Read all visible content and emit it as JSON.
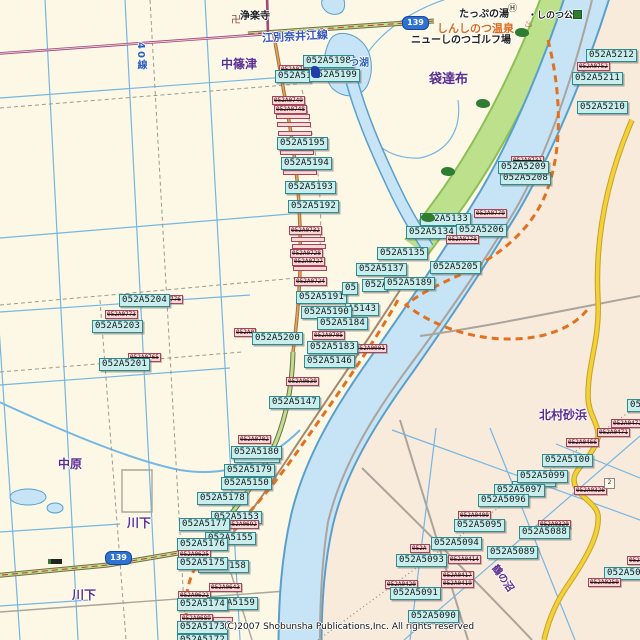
{
  "map": {
    "copyright": "(C)2007 Shobunsha Publications,Inc. All rights reserved",
    "colors": {
      "land_left": "#FDF8E6",
      "land_right": "#F8EBDB",
      "water_fill": "#C6E4F6",
      "water_line": "#58A0CC",
      "green_belt": "#BCE08C",
      "cyan_label_bg": "#C9ECEC",
      "cyan_label_border": "#2F8C8C",
      "pink_label_bg": "#F8D9DB",
      "pink_label_border": "#AA4455",
      "road_yellow": "#F2D235",
      "road_orange": "#E2701C",
      "road_green": "#BEE08E",
      "road_maroon": "#A04878",
      "purple_text": "#5B2D8E",
      "blue_text": "#2B5FC0",
      "badge_blue": "#2E72D2"
    },
    "route_badges": [
      {
        "text": "139",
        "x": 402,
        "y": 16
      },
      {
        "text": "139",
        "x": 105,
        "y": 551
      }
    ],
    "places": [
      {
        "text": "浄楽寺",
        "x": 240,
        "y": 7,
        "c": "#222222",
        "s": 10
      },
      {
        "text": "江別奈井江線",
        "x": 262,
        "y": 28,
        "c": "#3355BB",
        "s": 11,
        "rot": -3
      },
      {
        "text": "中篠津",
        "x": 221,
        "y": 55,
        "c": "#5B2D8E",
        "s": 12
      },
      {
        "text": "40線",
        "x": 133,
        "y": 42,
        "c": "#2B5FC0",
        "s": 10,
        "vert": true
      },
      {
        "text": "つ湖",
        "x": 349,
        "y": 54,
        "c": "#2B5FC0",
        "s": 10
      },
      {
        "text": "たっぷの湯",
        "x": 459,
        "y": 5,
        "c": "#222222",
        "s": 10
      },
      {
        "text": "・しのつ公園",
        "x": 528,
        "y": 8,
        "c": "#222222",
        "s": 9
      },
      {
        "text": "しんしのつ温泉",
        "x": 437,
        "y": 20,
        "c": "#E06818",
        "s": 11
      },
      {
        "text": "ニューしのつゴルフ場",
        "x": 411,
        "y": 31,
        "c": "#222222",
        "s": 10
      },
      {
        "text": "袋達布",
        "x": 429,
        "y": 68,
        "c": "#5B2D8E",
        "s": 13
      },
      {
        "text": "北村砂浜",
        "x": 539,
        "y": 406,
        "c": "#5B2D8E",
        "s": 12
      },
      {
        "text": "中原",
        "x": 58,
        "y": 455,
        "c": "#5B2D8E",
        "s": 12
      },
      {
        "text": "川下",
        "x": 127,
        "y": 514,
        "c": "#5B2D8E",
        "s": 12
      },
      {
        "text": "川下",
        "x": 72,
        "y": 586,
        "c": "#5B2D8E",
        "s": 12
      },
      {
        "text": "鶴の沼",
        "x": 489,
        "y": 570,
        "c": "#5B2D8E",
        "s": 10,
        "rot": 55
      }
    ],
    "labels": [
      {
        "type": "pink",
        "text": "052A0751",
        "x": 279,
        "y": 65
      },
      {
        "type": "cyan",
        "text": "052A51",
        "x": 275,
        "y": 70,
        "w": 36
      },
      {
        "type": "cyan",
        "text": "052A5198",
        "x": 303,
        "y": 55
      },
      {
        "type": "cyan",
        "text": "052A5199",
        "x": 309,
        "y": 69
      },
      {
        "type": "pink-strip",
        "x": 276,
        "y": 114,
        "w": 34
      },
      {
        "type": "pink-strip",
        "x": 277,
        "y": 122,
        "w": 34
      },
      {
        "type": "pink-strip",
        "x": 278,
        "y": 131,
        "w": 34
      },
      {
        "type": "pink",
        "text": "052A0749",
        "x": 272,
        "y": 96
      },
      {
        "type": "pink",
        "text": "052A0748",
        "x": 274,
        "y": 105
      },
      {
        "type": "pink-strip",
        "x": 280,
        "y": 150,
        "w": 34
      },
      {
        "type": "cyan",
        "text": "052A5195",
        "x": 277,
        "y": 137
      },
      {
        "type": "pink-strip",
        "x": 283,
        "y": 170,
        "w": 34
      },
      {
        "type": "cyan",
        "text": "052A5194",
        "x": 281,
        "y": 157
      },
      {
        "type": "cyan",
        "text": "052A5193",
        "x": 285,
        "y": 181
      },
      {
        "type": "cyan",
        "text": "052A5192",
        "x": 288,
        "y": 200
      },
      {
        "type": "pink",
        "text": "052A0732",
        "x": 289,
        "y": 226
      },
      {
        "type": "pink-strip",
        "x": 291,
        "y": 237,
        "w": 34
      },
      {
        "type": "pink-strip",
        "x": 292,
        "y": 244,
        "w": 34
      },
      {
        "type": "pink",
        "text": "052A0728",
        "x": 290,
        "y": 249
      },
      {
        "type": "pink",
        "text": "052A0727",
        "x": 292,
        "y": 257
      },
      {
        "type": "pink-strip",
        "x": 293,
        "y": 266,
        "w": 34
      },
      {
        "type": "pink",
        "text": "052A0724",
        "x": 294,
        "y": 277
      },
      {
        "type": "cyan",
        "text": "052A5191",
        "x": 296,
        "y": 291
      },
      {
        "type": "cyan",
        "text": "05",
        "x": 342,
        "y": 282,
        "w": 16
      },
      {
        "type": "cyan",
        "text": "052A",
        "x": 362,
        "y": 279,
        "w": 26
      },
      {
        "type": "cyan",
        "text": "A5143",
        "x": 345,
        "y": 303,
        "w": 34
      },
      {
        "type": "cyan",
        "text": "052A5190",
        "x": 301,
        "y": 306
      },
      {
        "type": "cyan",
        "text": "052A5189",
        "x": 384,
        "y": 277
      },
      {
        "type": "pink",
        "text": "052A0705",
        "x": 312,
        "y": 331
      },
      {
        "type": "cyan",
        "text": "052A5184",
        "x": 317,
        "y": 317
      },
      {
        "type": "pink",
        "text": "052A0001",
        "x": 354,
        "y": 344
      },
      {
        "type": "cyan",
        "text": "052A5183",
        "x": 307,
        "y": 341
      },
      {
        "type": "cyan",
        "text": "052A5146",
        "x": 304,
        "y": 355
      },
      {
        "type": "pink",
        "text": "052A0630",
        "x": 286,
        "y": 377
      },
      {
        "type": "cyan",
        "text": "052A5147",
        "x": 269,
        "y": 396
      },
      {
        "type": "pink",
        "text": "052A0779",
        "x": 474,
        "y": 209
      },
      {
        "type": "cyan",
        "text": "052A5133",
        "x": 420,
        "y": 213
      },
      {
        "type": "cyan",
        "text": "052A5134",
        "x": 406,
        "y": 226
      },
      {
        "type": "cyan",
        "text": "052A5206",
        "x": 456,
        "y": 224
      },
      {
        "type": "pink",
        "text": "052A0778",
        "x": 446,
        "y": 235
      },
      {
        "type": "cyan",
        "text": "052A5135",
        "x": 377,
        "y": 247
      },
      {
        "type": "cyan",
        "text": "052A5137",
        "x": 356,
        "y": 263
      },
      {
        "type": "cyan",
        "text": "052A5205",
        "x": 430,
        "y": 261
      },
      {
        "type": "pink",
        "text": "052A0731",
        "x": 511,
        "y": 156
      },
      {
        "type": "cyan",
        "text": "052A5208",
        "x": 500,
        "y": 172
      },
      {
        "type": "cyan",
        "text": "052A5209",
        "x": 498,
        "y": 161
      },
      {
        "type": "cyan",
        "text": "052A5212",
        "x": 586,
        "y": 49
      },
      {
        "type": "pink",
        "text": "052A0752",
        "x": 577,
        "y": 62
      },
      {
        "type": "cyan",
        "text": "052A5211",
        "x": 572,
        "y": 72
      },
      {
        "type": "cyan",
        "text": "052A5210",
        "x": 577,
        "y": 101
      },
      {
        "type": "pink",
        "text": "052A0776",
        "x": 150,
        "y": 295
      },
      {
        "type": "cyan",
        "text": "052A5204",
        "x": 119,
        "y": 294
      },
      {
        "type": "pink",
        "text": "052A0773",
        "x": 105,
        "y": 310
      },
      {
        "type": "cyan",
        "text": "052A5203",
        "x": 92,
        "y": 320
      },
      {
        "type": "pink",
        "text": "052A0765",
        "x": 128,
        "y": 353
      },
      {
        "type": "cyan",
        "text": "052A5201",
        "x": 99,
        "y": 358
      },
      {
        "type": "pink",
        "text": "052A07",
        "x": 234,
        "y": 328,
        "w": 22
      },
      {
        "type": "cyan",
        "text": "052A5200",
        "x": 252,
        "y": 332
      },
      {
        "type": "pink",
        "text": "052A0702",
        "x": 238,
        "y": 435
      },
      {
        "type": "cyan-strip",
        "x": 234,
        "y": 457,
        "w": 46
      },
      {
        "type": "cyan",
        "text": "052A5180",
        "x": 231,
        "y": 446
      },
      {
        "type": "cyan",
        "text": "052A5179",
        "x": 224,
        "y": 464
      },
      {
        "type": "cyan",
        "text": "052A5150",
        "x": 221,
        "y": 477
      },
      {
        "type": "cyan",
        "text": "052A5178",
        "x": 197,
        "y": 492
      },
      {
        "type": "cyan",
        "text": "052A5153",
        "x": 211,
        "y": 511
      },
      {
        "type": "pink",
        "text": "052A0692",
        "x": 226,
        "y": 520
      },
      {
        "type": "cyan",
        "text": "052A5177",
        "x": 179,
        "y": 518
      },
      {
        "type": "cyan",
        "text": "052A5155",
        "x": 205,
        "y": 532
      },
      {
        "type": "cyan",
        "text": "052A5176",
        "x": 177,
        "y": 538
      },
      {
        "type": "pink",
        "text": "052A0625",
        "x": 178,
        "y": 550
      },
      {
        "type": "cyan",
        "text": "052A5158",
        "x": 198,
        "y": 560
      },
      {
        "type": "cyan",
        "text": "052A5175",
        "x": 177,
        "y": 557
      },
      {
        "type": "pink",
        "text": "052A0643",
        "x": 209,
        "y": 583
      },
      {
        "type": "pink",
        "text": "052A0622",
        "x": 178,
        "y": 591
      },
      {
        "type": "cyan",
        "text": "052A5159",
        "x": 207,
        "y": 597
      },
      {
        "type": "cyan",
        "text": "052A5174",
        "x": 177,
        "y": 598
      },
      {
        "type": "pink",
        "text": "052A0689",
        "x": 180,
        "y": 614
      },
      {
        "type": "pink-strip",
        "x": 213,
        "y": 617,
        "w": 20
      },
      {
        "type": "cyan",
        "text": "052A5173",
        "x": 177,
        "y": 621
      },
      {
        "type": "cyan",
        "text": "052A5172",
        "x": 177,
        "y": 634
      },
      {
        "type": "cyan",
        "text": "05",
        "x": 627,
        "y": 399,
        "w": 14
      },
      {
        "type": "pink",
        "text": "052A0472",
        "x": 611,
        "y": 419
      },
      {
        "type": "pink",
        "text": "052A0471",
        "x": 597,
        "y": 428
      },
      {
        "type": "pink",
        "text": "052A0466",
        "x": 566,
        "y": 438
      },
      {
        "type": "cyan",
        "text": "052A5100",
        "x": 542,
        "y": 454
      },
      {
        "type": "cyan-strip",
        "x": 512,
        "y": 481,
        "w": 44
      },
      {
        "type": "cyan",
        "text": "052A5099",
        "x": 517,
        "y": 470
      },
      {
        "type": "cyan",
        "text": "052A5097",
        "x": 494,
        "y": 484
      },
      {
        "type": "cyan",
        "text": "052A5096",
        "x": 478,
        "y": 494
      },
      {
        "type": "pink",
        "text": "052A0326",
        "x": 574,
        "y": 486
      },
      {
        "type": "pink",
        "text": "052A0400",
        "x": 458,
        "y": 511
      },
      {
        "type": "cyan",
        "text": "052A5095",
        "x": 454,
        "y": 519
      },
      {
        "type": "pink",
        "text": "052A0320",
        "x": 538,
        "y": 520
      },
      {
        "type": "cyan",
        "text": "052A5088",
        "x": 519,
        "y": 526
      },
      {
        "type": "pink",
        "text": "052A",
        "x": 410,
        "y": 544,
        "w": 20
      },
      {
        "type": "cyan",
        "text": "052A5094",
        "x": 431,
        "y": 537
      },
      {
        "type": "cyan",
        "text": "052A5089",
        "x": 487,
        "y": 546
      },
      {
        "type": "pink",
        "text": "052A0414",
        "x": 448,
        "y": 555
      },
      {
        "type": "cyan",
        "text": "052A5093",
        "x": 396,
        "y": 554
      },
      {
        "type": "pink",
        "text": "052A0417",
        "x": 441,
        "y": 571
      },
      {
        "type": "pink",
        "text": "052A0419",
        "x": 441,
        "y": 579
      },
      {
        "type": "pink",
        "text": "052A0420",
        "x": 385,
        "y": 580
      },
      {
        "type": "cyan",
        "text": "052A5091",
        "x": 390,
        "y": 587
      },
      {
        "type": "cyan",
        "text": "052A5090",
        "x": 408,
        "y": 610
      },
      {
        "type": "pink",
        "text": "052A",
        "x": 627,
        "y": 556,
        "w": 14
      },
      {
        "type": "cyan",
        "text": "052A50",
        "x": 604,
        "y": 567,
        "w": 37
      },
      {
        "type": "pink",
        "text": "052A0250",
        "x": 588,
        "y": 578
      }
    ],
    "icons": [
      {
        "name": "temple-icon",
        "glyph": "卍",
        "x": 231,
        "y": 16
      },
      {
        "name": "hotel-icon",
        "glyph": "Ⓗ",
        "x": 508,
        "y": 5
      },
      {
        "name": "onsen-icon",
        "glyph": "♨",
        "x": 524,
        "y": 20
      },
      {
        "name": "park-icon",
        "x": 573,
        "y": 10
      },
      {
        "name": "tree-icon",
        "x": 515,
        "y": 28
      },
      {
        "name": "tree-icon",
        "x": 476,
        "y": 99
      },
      {
        "name": "tree-icon",
        "x": 441,
        "y": 167
      },
      {
        "name": "tree-icon",
        "x": 421,
        "y": 213
      },
      {
        "name": "poi-blue-icon",
        "x": 311,
        "y": 66
      },
      {
        "name": "bus-stop-icon",
        "x": 48,
        "y": 559
      },
      {
        "name": "count-2-icon",
        "glyph": "2",
        "x": 604,
        "y": 478
      }
    ]
  }
}
